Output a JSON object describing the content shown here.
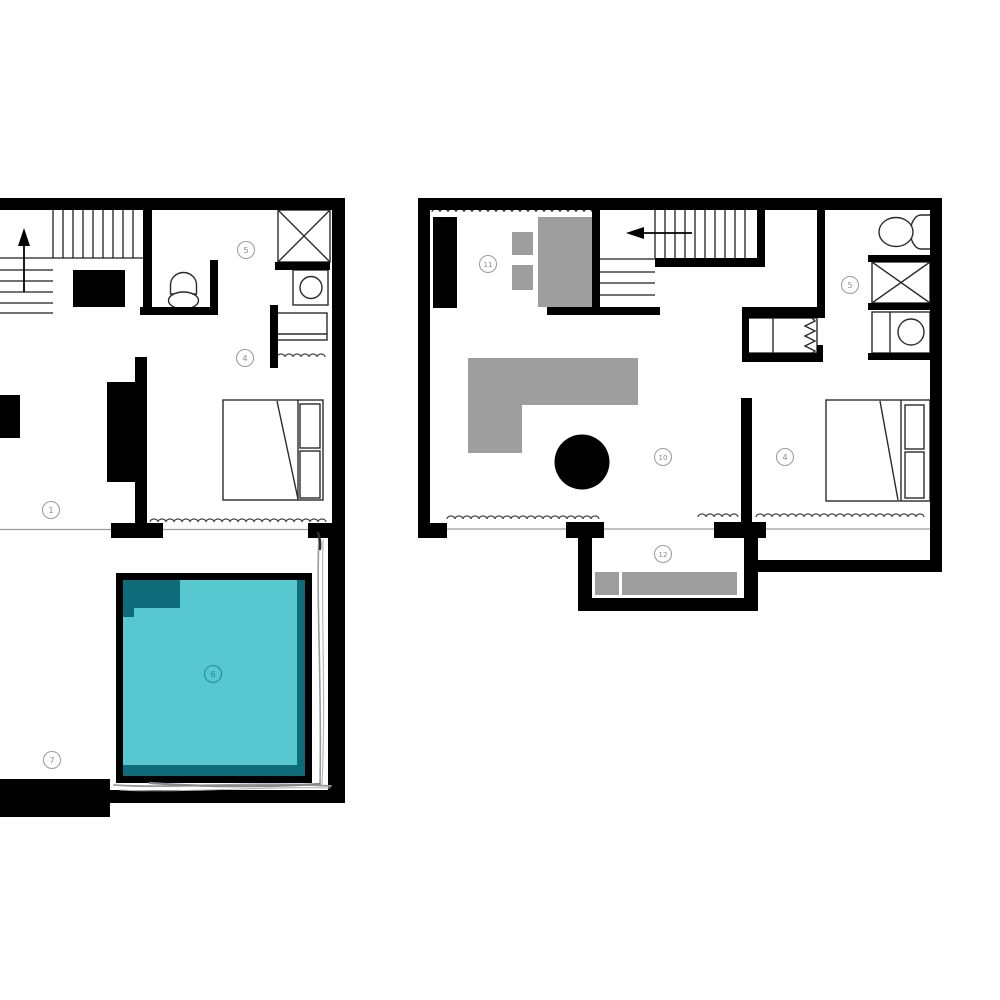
{
  "page": {
    "type": "architectural floor plan drawing, two levels side by side",
    "background": "#ffffff"
  },
  "colors": {
    "wall": "#000000",
    "furniture_gray": "#9e9e9e",
    "pool_water": "#57c7d0",
    "pool_shadow": "#0d6b7a",
    "label_gray": "#8a8a8a",
    "pool_label_teal": "#2e8794"
  },
  "lower_floor": {
    "labels": {
      "living": "1",
      "bedroom": "4",
      "bathroom": "5",
      "pool": "6",
      "terrace": "7"
    }
  },
  "upper_floor": {
    "labels": {
      "kitchen": "11",
      "bathroom": "5",
      "living": "10",
      "bedroom": "4",
      "balcony": "12"
    }
  }
}
